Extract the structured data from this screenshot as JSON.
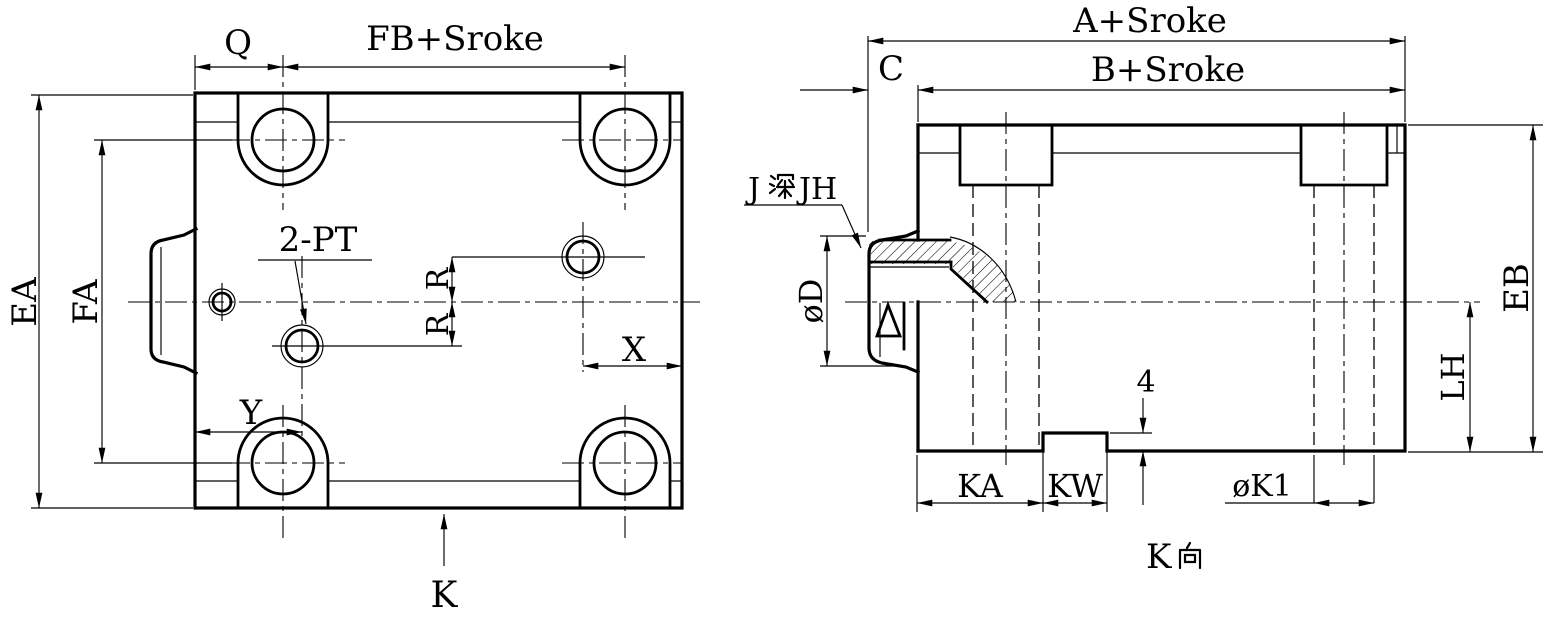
{
  "plan_view": {
    "dims": {
      "q": "Q",
      "fb_stroke": "FB+Sroke",
      "ea": "EA",
      "fa": "FA",
      "x": "X",
      "y": "Y",
      "r_upper": "R",
      "r_lower": "R"
    },
    "port_label": "2-PT",
    "view_arrow_label": "K"
  },
  "side_view": {
    "dims": {
      "a_stroke": "A+Sroke",
      "b_stroke": "B+Sroke",
      "c": "C",
      "dia_d": "øD",
      "eb": "EB",
      "lh": "LH",
      "ka": "KA",
      "kw": "KW",
      "notch_depth": "4",
      "dia_k1": "øK1"
    },
    "counterbore_label": {
      "prefix": "J",
      "cjk": "深",
      "suffix": "JH",
      "full": "J深JH"
    },
    "view_label": {
      "prefix": "K",
      "cjk": "向",
      "full": "K向"
    }
  },
  "colors": {
    "line": "#000000",
    "background": "#ffffff"
  }
}
